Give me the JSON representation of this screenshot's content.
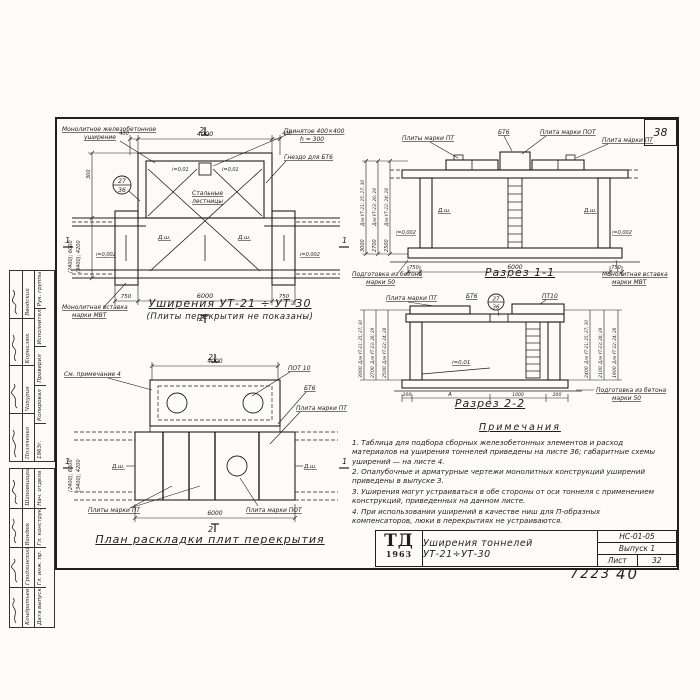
{
  "sheet": {
    "corner_number": "38",
    "handwritten_left": "7223",
    "handwritten_right": "40"
  },
  "plan_top": {
    "caption": "Уширения УТ-21 ÷ УТ-30",
    "subcaption": "(Плиты перекрытия не показаны)",
    "label_widening_1": "Монолитное железобетонное",
    "label_widening_2": "уширение",
    "label_accepted_1": "Принятое 400×400",
    "label_accepted_2": "h = 300",
    "label_socket": "Гнездо для БТ6",
    "label_stairs_1": "Стальные",
    "label_stairs_2": "лестницы",
    "label_insert_1": "Монолитная вставка",
    "label_insert_2": "марки МВТ",
    "detail_ref_top": "27",
    "detail_ref_bottom": "36",
    "slope_roof_left": "i=0,01",
    "slope_roof_right": "i=0,01",
    "slope_floor_left": "i=0,002",
    "slope_floor_right": "i=0,002",
    "joint_left": "Д.ш.",
    "joint_right": "Д.ш.",
    "dims": {
      "top": [
        "400",
        "4000",
        "400"
      ],
      "bottom": [
        "750",
        "6000",
        "750"
      ],
      "left_small": "300",
      "outer1": "(2400); 6000",
      "outer2": "(3400); 4200"
    },
    "section_mark_2": "2",
    "section_mark_1": "1"
  },
  "section11": {
    "caption": "Разрез 1-1",
    "label_pt_plates": "Плиты марки ПТ",
    "label_bt6": "БТ6",
    "label_pot_plate": "Плита марки ПОТ",
    "label_pt_plate": "Плита марки ПТ",
    "label_prep_1": "Подготовка из бетона",
    "label_prep_2": "марки 50",
    "label_insert_1": "Монолитная вставка",
    "label_insert_2": "марки МВТ",
    "joint_left": "Д.ш.",
    "joint_right": "Д.ш.",
    "slope_left": "i=0,002",
    "slope_right": "i=0,002",
    "rot": [
      {
        "label": "Для УТ-21; 25; 27; 30",
        "value": "3000"
      },
      {
        "label": "Для УТ-23; 26; 29",
        "value": "2700"
      },
      {
        "label": "Для УТ-22; 24; 28",
        "value": "2500"
      }
    ],
    "dims_bottom": [
      "750",
      "6000",
      "750"
    ]
  },
  "section22": {
    "caption": "Разрез 2-2",
    "label_pt_plate": "Плита марки ПТ",
    "label_bt6": "БТ6",
    "label_pt10": "ПТ10",
    "detail_ref_top": "27",
    "detail_ref_bottom": "36",
    "slope": "i=0,01",
    "label_prep_1": "Подготовка из бетона",
    "label_prep_2": "марки 50",
    "rot_left": [
      {
        "label": "Для УТ-21; 25; 27; 30",
        "value": "3000"
      },
      {
        "label": "Для УТ-23; 26; 29",
        "value": "2700"
      },
      {
        "label": "Для УТ-22; 24; 28",
        "value": "2500"
      }
    ],
    "rot_right": [
      {
        "label": "Для УТ-21; 25; 27; 30",
        "value": "2400"
      },
      {
        "label": "Для УТ-23; 26; 29",
        "value": "2100"
      },
      {
        "label": "Для УТ-22; 24; 28",
        "value": "1900"
      }
    ],
    "dims_bottom": [
      "200",
      "А",
      "1000",
      "200"
    ]
  },
  "plan_bottom": {
    "caption": "План раскладки плит перекрытия",
    "label_note": "См. примечание 4",
    "label_pot10": "ПОТ 10",
    "label_bt6": "БТ6",
    "label_pt_plate_right": "Плита марки ПТ",
    "label_pt_plates": "Плиты марки ПТ",
    "label_pot_plate": "Плита марки ПОТ",
    "joint_left": "Д.ш.",
    "joint_right": "Д.ш.",
    "dims": {
      "top": "4000",
      "bottom": "6000",
      "outer1": "(2400); 6000",
      "outer2": "(3400); 4200"
    },
    "section_mark_2": "2",
    "section_mark_1": "1"
  },
  "notes": {
    "title": "Примечания",
    "items": [
      "1. Таблица для подбора сборных железобетонных элементов и расход материалов на уширения тоннелей приведены на листе 36; габаритные схемы уширений — на листе 4.",
      "2. Опалубочные и арматурные чертежи монолитных конструкций уширений приведены в выпуске 3.",
      "3. Уширения могут устраиваться в обе стороны от оси тоннеля с применением конструкций, приведенных на данном листе.",
      "4. При использовании уширений в качестве ниш для П-образных компенсаторов, люки в перекрытиях не устраиваются."
    ]
  },
  "titleblock": {
    "logo_top": "ТД",
    "logo_bottom": "1963",
    "title": "Уширения тоннелей УТ-21÷УТ-30",
    "code": "НС-01-05",
    "issue": "Выпуск 1",
    "sheet_label": "Лист",
    "sheet_number": "32"
  },
  "stamp": {
    "group1": {
      "roles": [
        "Рук. группы",
        "Исполнитель",
        "Проверил",
        "Копировал"
      ],
      "names": [
        "Вводский",
        "Корнилюк",
        "Чапурин",
        "Поляченко"
      ],
      "year": "1963г."
    },
    "group2": {
      "roles": [
        "Нач. отдела",
        "Гл. конструктор",
        "Гл. инж. пр.",
        "Дата выпуска"
      ],
      "names": [
        "Шаповницкий",
        "Вандюк",
        "Гридзинский",
        "Кондратьев"
      ]
    }
  }
}
